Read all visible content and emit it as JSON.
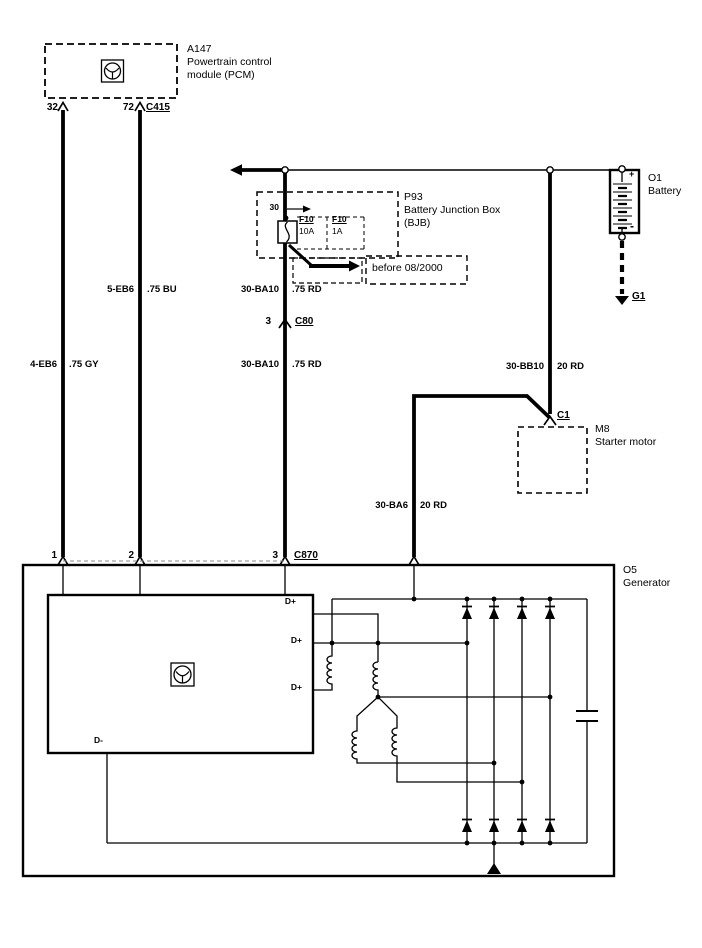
{
  "pcm": {
    "id": "A147",
    "name_line1": "Powertrain control",
    "name_line2": "module (PCM)",
    "pin_left": "32",
    "pin_right": "72",
    "connector": "C415"
  },
  "bjb": {
    "id": "P93",
    "name_line1": "Battery Junction Box",
    "name_line2": "(BJB)",
    "terminal": "30",
    "fuse_a": {
      "id": "F10",
      "rating": "10A"
    },
    "fuse_b": {
      "id": "F10",
      "rating": "1A"
    },
    "note": "before 08/2000"
  },
  "battery": {
    "id": "O1",
    "name": "Battery",
    "plus": "+",
    "minus": "-",
    "ground": "G1"
  },
  "starter": {
    "id": "M8",
    "name": "Starter motor",
    "connector": "C1"
  },
  "c80": {
    "pin": "3",
    "id": "C80"
  },
  "generator": {
    "id": "O5",
    "name": "Generator",
    "connector": "C870",
    "pin1": "1",
    "pin2": "2",
    "pin3": "3",
    "regulator": {
      "dplus": "D+",
      "dminus": "D-"
    }
  },
  "wires": {
    "w1": {
      "code": "4-EB6",
      "spec": ".75 GY"
    },
    "w2": {
      "code": "5-EB6",
      "spec": ".75 BU"
    },
    "w3": {
      "code": "30-BA10",
      "spec": ".75 RD"
    },
    "w4": {
      "code": "30-BA6",
      "spec": "20 RD"
    },
    "w5": {
      "code": "30-BB10",
      "spec": "20 RD"
    }
  },
  "colors": {
    "line": "#000000",
    "background": "#ffffff"
  }
}
